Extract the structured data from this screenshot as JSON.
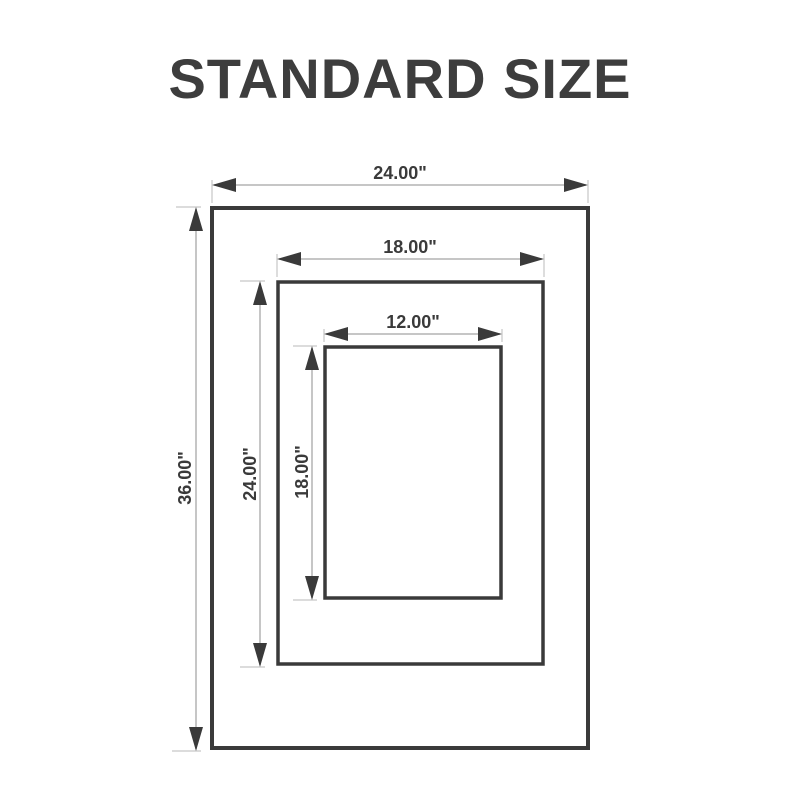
{
  "title": "STANDARD SIZE",
  "colors": {
    "ink": "#3a3a3a",
    "title_text": "#3d3d3d",
    "dimension_line": "#b3b3b3",
    "extension_line": "#c6c6c6",
    "background": "#ffffff"
  },
  "frames": [
    {
      "name": "outer",
      "width_label": "24.00\"",
      "height_label": "36.00\""
    },
    {
      "name": "middle",
      "width_label": "18.00\"",
      "height_label": "24.00\""
    },
    {
      "name": "inner",
      "width_label": "12.00\"",
      "height_label": "18.00\""
    }
  ]
}
